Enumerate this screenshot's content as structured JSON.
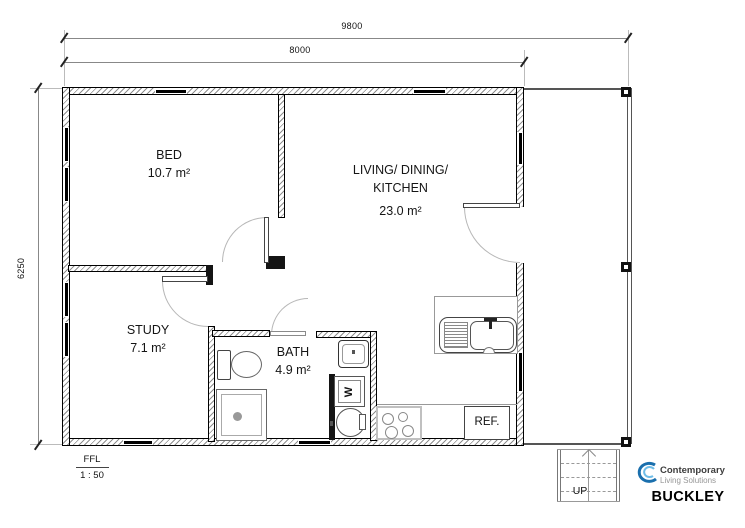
{
  "dimensions": {
    "overall_width": "9800",
    "building_width": "8000",
    "overall_depth": "6250"
  },
  "rooms": {
    "bed": {
      "name": "BED",
      "area": "10.7 m²"
    },
    "living": {
      "name_line1": "LIVING/ DINING/",
      "name_line2": "KITCHEN",
      "area": "23.0 m²"
    },
    "study": {
      "name": "STUDY",
      "area": "7.1 m²"
    },
    "bath": {
      "name": "BATH",
      "area": "4.9 m²"
    }
  },
  "fixtures": {
    "fridge_label": "REF.",
    "washer_label": "W"
  },
  "stairs": {
    "up_label": "UP"
  },
  "scale_block": {
    "level_label": "FFL",
    "scale": "1 : 50"
  },
  "title_block": {
    "brand_line1": "Contemporary",
    "brand_line2": "Living Solutions",
    "plan_name": "BUCKLEY"
  },
  "colors": {
    "logo_blue_dark": "#1a6fad",
    "logo_blue_light": "#6fbde8"
  }
}
